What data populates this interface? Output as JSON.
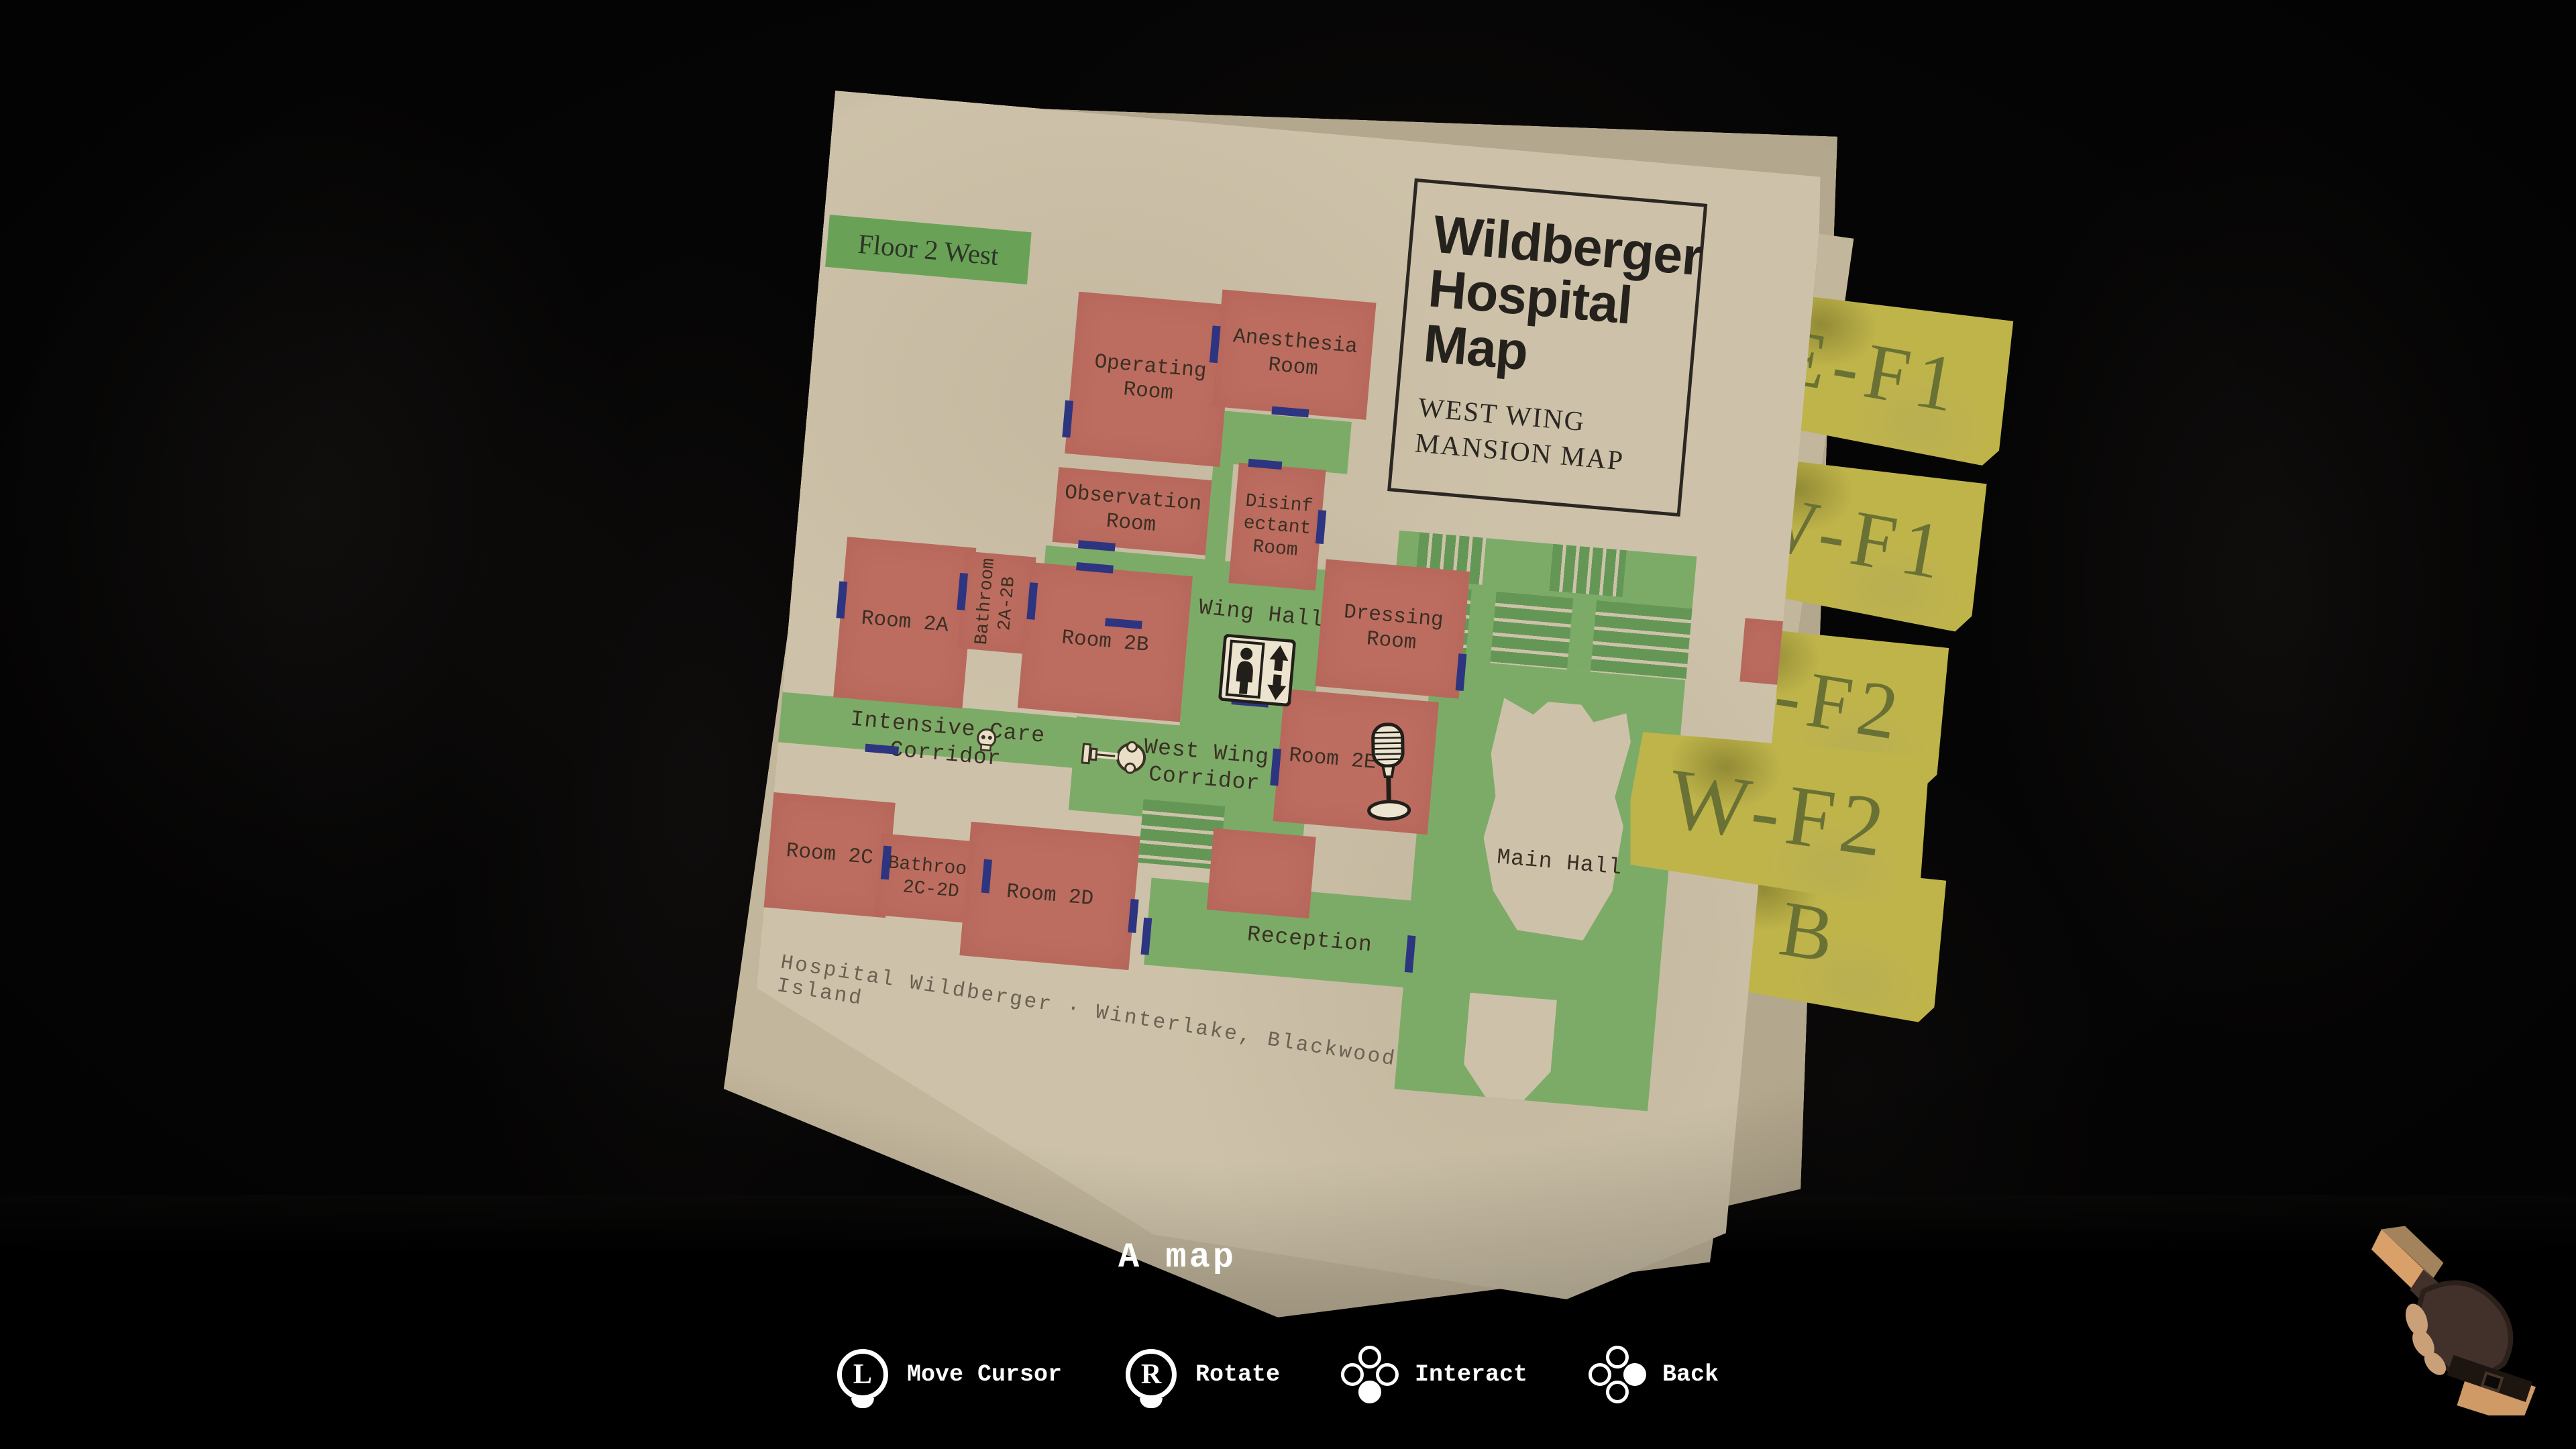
{
  "item_caption": "A map",
  "map": {
    "floor_banner": "Floor 2 West",
    "title_box": {
      "title": "Wildberger Hospital Map",
      "subtitle": [
        "WEST WING",
        "MANSION MAP"
      ]
    },
    "footer_caption": "Hospital Wildberger · Winterlake, Blackwood Island",
    "rooms": {
      "operating": "Operating Room",
      "anesthesia": "Anesthesia Room",
      "observation": "Observation Room",
      "disinfectant": "Disinfectant Room",
      "dressing": "Dressing Room",
      "room2a": "Room 2A",
      "room2b": "Room 2B",
      "bathroom2a2b": "Bathroom 2A-2B",
      "room2c": "Room 2C",
      "bathroom2c2d": "Bathroom 2C-2D",
      "room2d": "Room 2D",
      "room2e": "Room 2E"
    },
    "areas": {
      "west_wing_hallway": "West Wing Hallway",
      "intensive_care_corridor": "Intensive Care Corridor",
      "west_wing_corridor": "West Wing Corridor",
      "reception": "Reception",
      "main_hall": "Main Hall"
    },
    "icons": [
      "elevator-icon",
      "microphone-save-icon",
      "key-item-icon",
      "skull-icon"
    ]
  },
  "floor_tabs": [
    {
      "label": "E-F1",
      "selected": false
    },
    {
      "label": "W-F1",
      "selected": false
    },
    {
      "label": "E-F2",
      "selected": false
    },
    {
      "label": "W-F2",
      "selected": true
    },
    {
      "label": "B",
      "selected": false
    }
  ],
  "controls": [
    {
      "icon": "left-stick-icon",
      "key": "L",
      "label": "Move Cursor"
    },
    {
      "icon": "right-stick-icon",
      "key": "R",
      "label": "Rotate"
    },
    {
      "icon": "face-button-bottom-icon",
      "label": "Interact"
    },
    {
      "icon": "face-button-right-icon",
      "label": "Back"
    }
  ],
  "colors": {
    "room_red": "#bc6d60",
    "corridor_green": "#7cab68",
    "door_blue": "#2d3480",
    "tab_yellow": "#bfb44a",
    "paper": "#cdc2a9",
    "banner_green": "#69a257"
  }
}
